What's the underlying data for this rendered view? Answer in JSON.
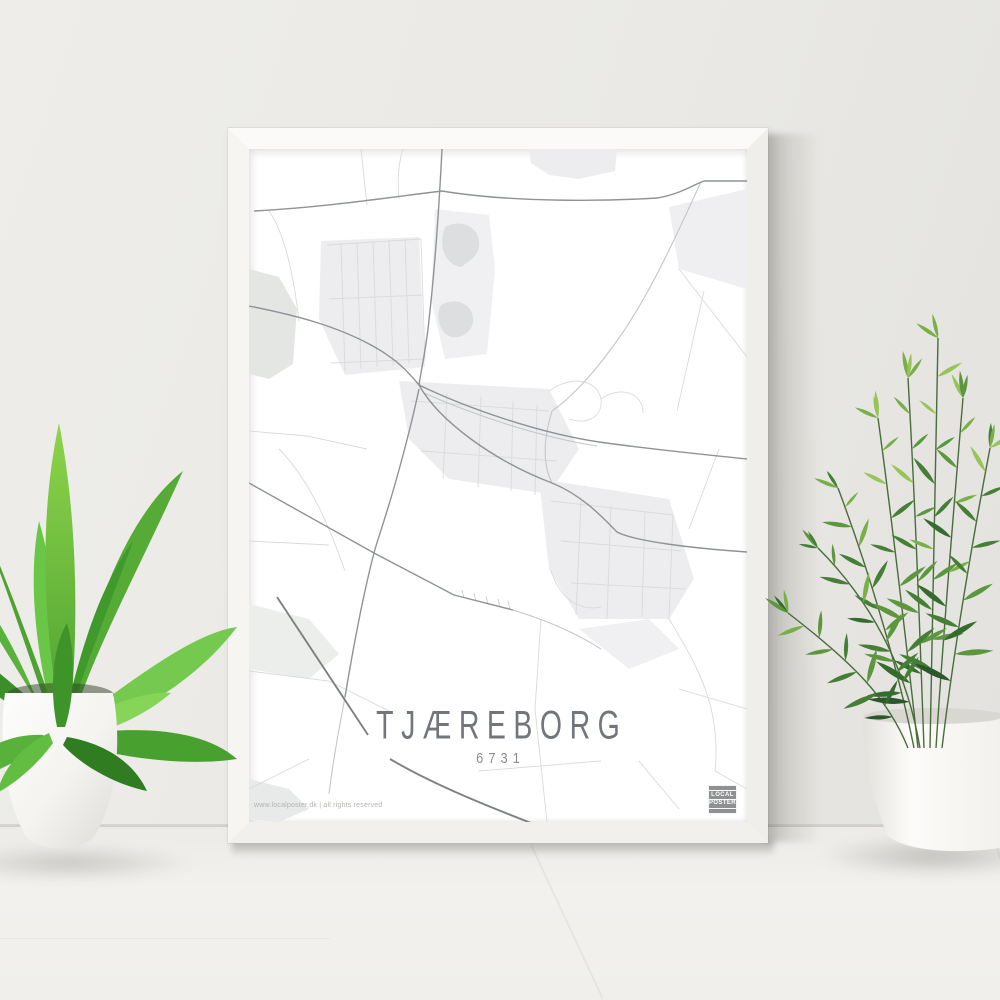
{
  "poster": {
    "title": "TJÆREBORG",
    "postal_code": "6731",
    "copyright": "www.localposter.dk | all rights reserved",
    "brand": {
      "line1": "LOCAL",
      "line2": "POSTER"
    }
  },
  "colors": {
    "wall": "#eae9e5",
    "floor": "#f2f1ee",
    "frame": "#f8f7f5",
    "poster_background": "#ffffff",
    "title_text": "#72767a",
    "postal_text": "#878b8e",
    "copyright_text": "#b2b2af",
    "badge_background": "#8f9092",
    "badge_text": "#ffffff",
    "map_block": "#ededef",
    "map_water": "#dcdee0",
    "map_road_main": "#8f9396",
    "map_road_bold": "#7d8184",
    "map_road_medium": "#c3c6c9",
    "map_road_minor": "#d9dadc",
    "plant_green_light": "#97c455",
    "plant_green_dark": "#2c572d",
    "pot_white": "#fcfbf9"
  }
}
